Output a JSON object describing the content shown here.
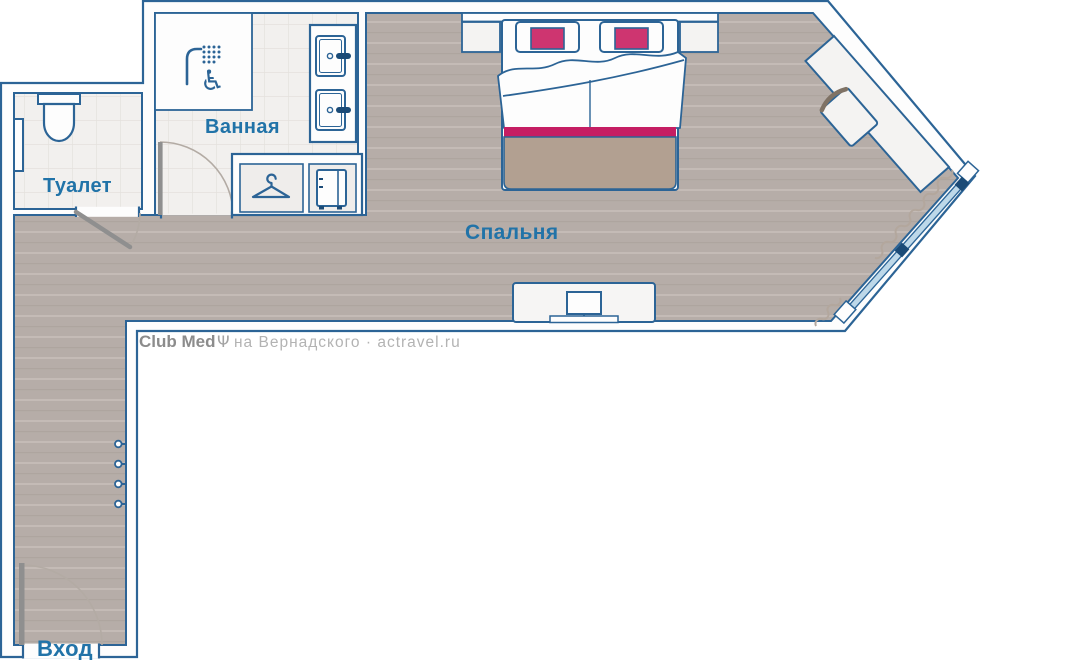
{
  "plan": {
    "rooms": [
      {
        "id": "toilet",
        "label": "Туалет"
      },
      {
        "id": "bathroom",
        "label": "Ванная"
      },
      {
        "id": "bedroom",
        "label": "Спальня"
      },
      {
        "id": "entrance",
        "label": "Вход"
      }
    ]
  },
  "watermark": {
    "brand": "Club Med",
    "trident": "Ψ",
    "suffix": "на Вернадского · actravel.ru"
  },
  "colors": {
    "outline_blue": "#2c6496",
    "label_blue": "#2173a8",
    "dark_navy": "#1b4b77",
    "pillow_pink": "#ce3570",
    "stripe_pink": "#c51e63",
    "blanket_tan": "#b2a091",
    "floor_gray": "#b6ada8",
    "tile_cream": "#f2f0ee",
    "window_glass": "#bdd8e9",
    "door_leaf_gray": "#8f8f8f",
    "watermark_gray": "#8c8c8c"
  },
  "icons": [
    "shower-icon",
    "wheelchair-accessible-icon",
    "toilet-icon",
    "towel-rail-icon",
    "hanger-icon",
    "minibar-icon",
    "sink-icon",
    "tv-icon",
    "coat-hook-icon",
    "door-swing-icon",
    "window-glyph",
    "desk-glyph",
    "chair-glyph"
  ]
}
